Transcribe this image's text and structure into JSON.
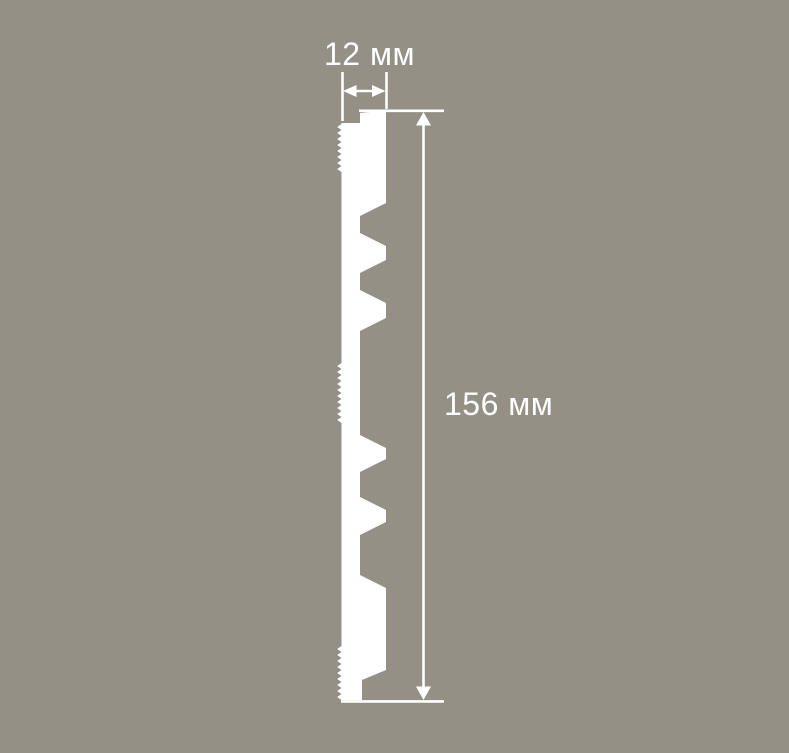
{
  "page": {
    "background_color": "#949085",
    "drawing_color": "#ffffff"
  },
  "diagram": {
    "kind": "panel-profile-cross-section",
    "dimensions": {
      "width": {
        "label": "12 мм",
        "value": 12,
        "unit": "мм"
      },
      "height": {
        "label": "156 мм",
        "value": 156,
        "unit": "мм"
      }
    }
  }
}
